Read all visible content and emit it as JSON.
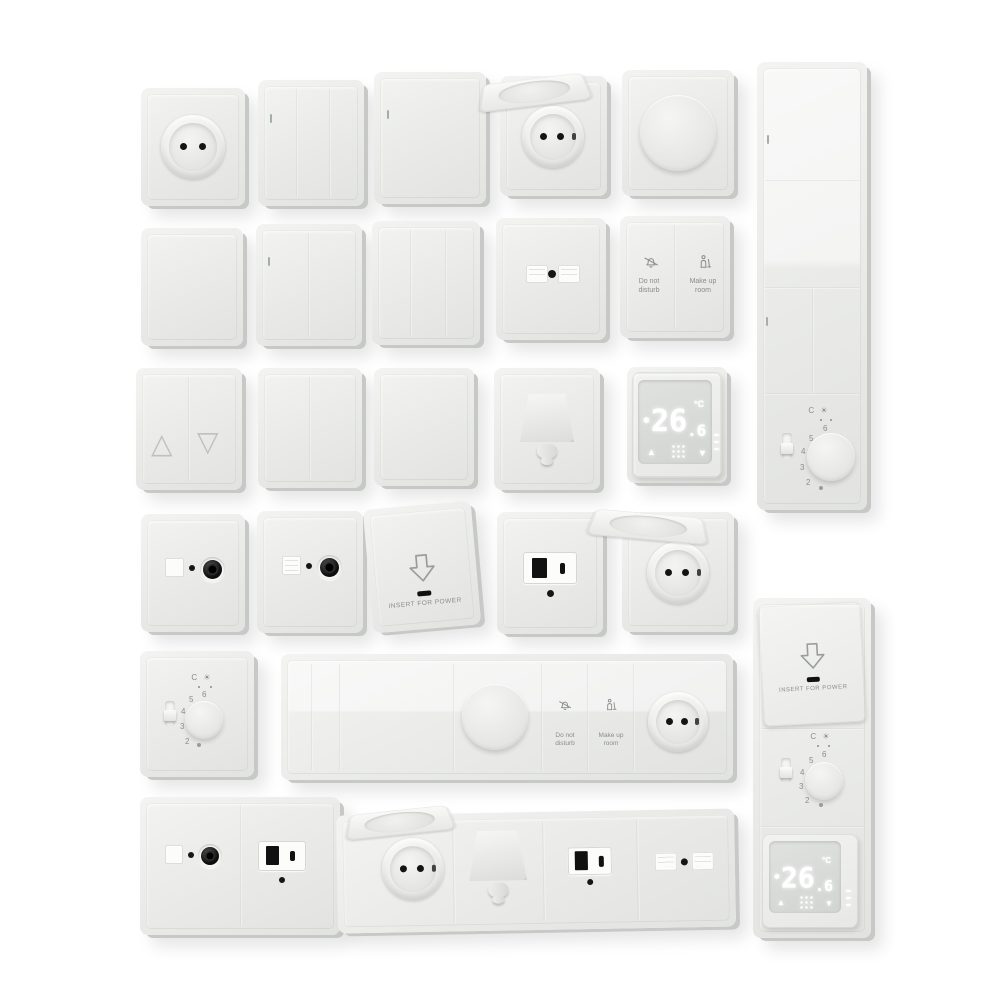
{
  "canvas": {
    "width": 1000,
    "height": 1000,
    "background": "#ffffff"
  },
  "palette": {
    "plate": "#eceeec",
    "plate_edge": "#c7c9c7",
    "glyph_gray": "#8a8d8a",
    "black": "#161616",
    "led_indicator": "#a3ada9",
    "display_glow": "#ffffff"
  },
  "hotel_switch": {
    "dnd_icon": "no-bell-icon",
    "dnd_line1": "Do not",
    "dnd_line2": "disturb",
    "mur_icon": "housekeeping-icon",
    "mur_line1": "Make up",
    "mur_line2": "room"
  },
  "keycard": {
    "arrow_icon": "down-arrow-icon",
    "label": "INSERT FOR POWER"
  },
  "digital_thermostat": {
    "temp": "26",
    "temp_frac": ".6",
    "unit": "°C",
    "mode_icon": "❄",
    "up_icon": "▲",
    "down_icon": "▼",
    "menu_icon": "dot-grid-icon"
  },
  "dial_thermostat": {
    "numbers": [
      "2",
      "3",
      "4",
      "5",
      "6"
    ],
    "top_label": "C ☀",
    "marker": "frost-dot"
  },
  "blinds_switch": {
    "up_icon": "△",
    "down_icon": "▽"
  },
  "catalog": [
    "schuko-socket",
    "switch-3-gang",
    "switch-1-gang",
    "lidded-schuko-socket",
    "rotary-dimmer",
    "vertical-multi-panel",
    "blank-plate",
    "switch-2-gang",
    "data-outlet-duplex",
    "hotel-service-switch",
    "blinds-switch",
    "cable-outlet",
    "digital-thermostat",
    "tv-sat-outlet",
    "keycard-switch",
    "usb-outlet",
    "dial-thermostat",
    "horizontal-multi-panel",
    "double-frame-tv-usb",
    "horizontal-socket-strip",
    "vertical-hotel-panel"
  ]
}
